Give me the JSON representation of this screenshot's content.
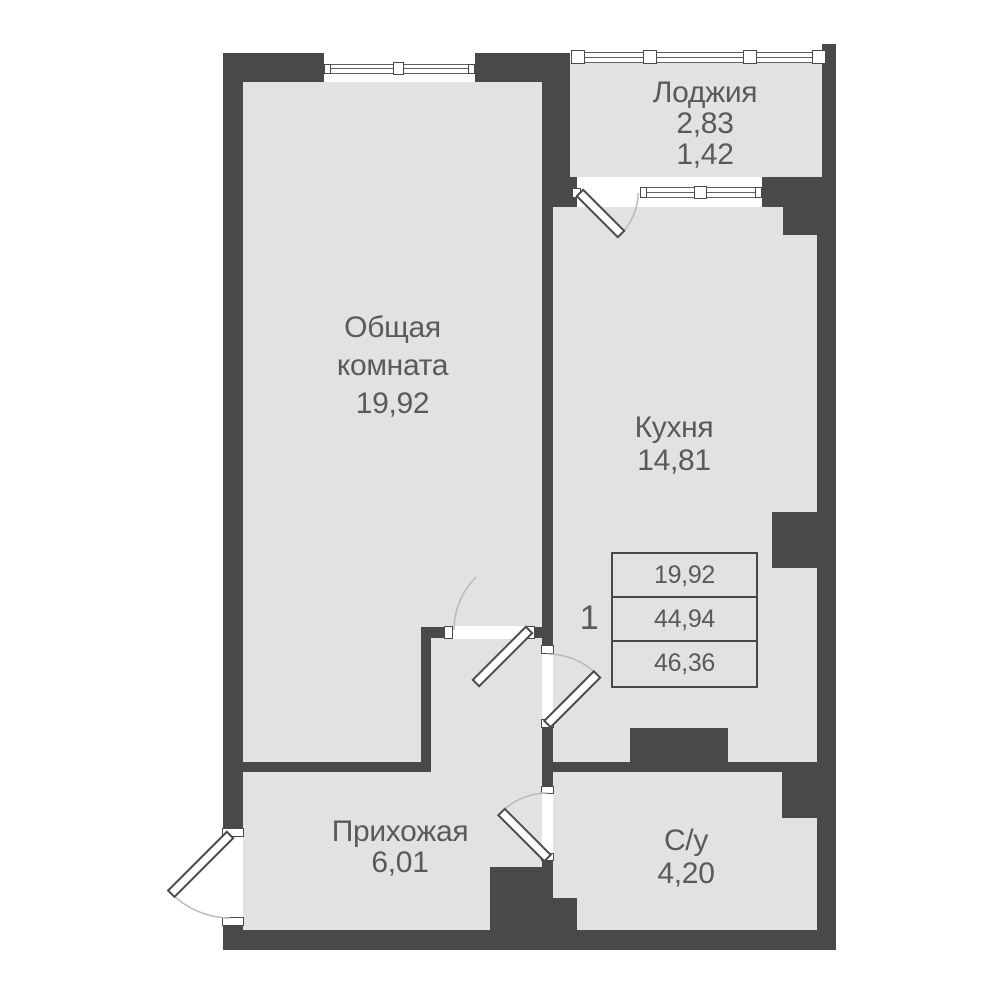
{
  "rooms": {
    "loggia": {
      "name": "Лоджия",
      "area1": "2,83",
      "area2": "1,42"
    },
    "living": {
      "name1": "Общая",
      "name2": "комната",
      "area": "19,92"
    },
    "kitchen": {
      "name": "Кухня",
      "area": "14,81"
    },
    "hallway": {
      "name": "Прихожая",
      "area": "6,01"
    },
    "bathroom": {
      "name": "С/у",
      "area": "4,20"
    }
  },
  "unit": {
    "number": "1"
  },
  "summary_table": {
    "row1": "19,92",
    "row2": "44,94",
    "row3": "46,36"
  },
  "palette": {
    "wall": "#494949",
    "floor": "#e2e2e2",
    "text": "#5a5a5a",
    "arc": "#b9b9b9"
  }
}
